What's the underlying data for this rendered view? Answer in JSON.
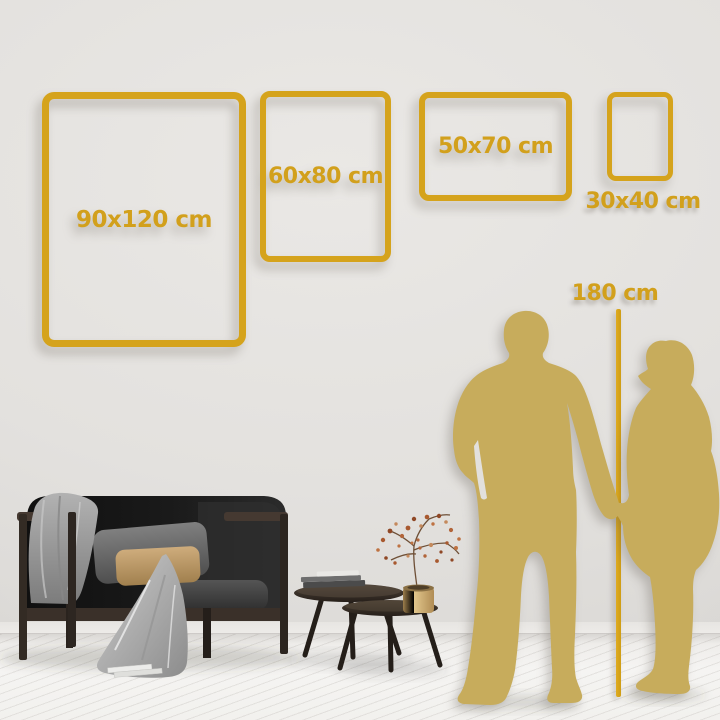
{
  "frames": [
    {
      "id": "90x120",
      "label": "90x120 cm"
    },
    {
      "id": "60x80",
      "label": "60x80 cm"
    },
    {
      "id": "50x70",
      "label": "50x70 cm"
    },
    {
      "id": "30x40",
      "label": "30x40 cm"
    }
  ],
  "height_reference": {
    "label": "180 cm"
  },
  "colors": {
    "gold": "#D5A31C",
    "gold-text": "#D2A01C",
    "silhouette": "#C7AC5C",
    "wall": "#E3E1DE",
    "floor": "#F1F0ED"
  }
}
